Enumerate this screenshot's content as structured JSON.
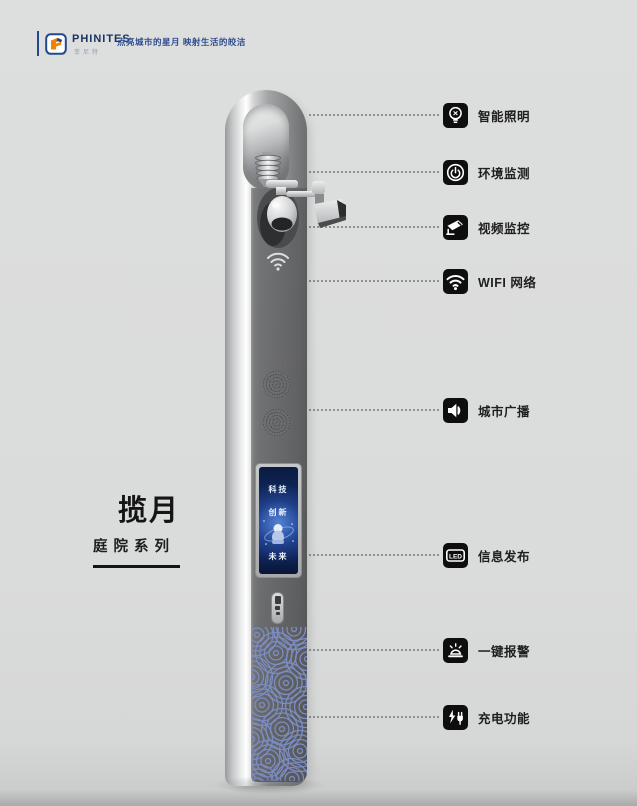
{
  "header": {
    "brand": "PHINITES",
    "brand_sub": "菲尼特",
    "tagline": "点亮城市的星月 映射生活的皎洁"
  },
  "product": {
    "title": "揽月",
    "series": "庭院系列"
  },
  "pole": {
    "screen": {
      "line1": "科技",
      "line2": "创新",
      "line3": "未来"
    }
  },
  "features": [
    {
      "id": "smart-lighting",
      "label": "智能照明",
      "icon": "bulb-icon"
    },
    {
      "id": "env-monitoring",
      "label": "环境监测",
      "icon": "env-sensor-icon"
    },
    {
      "id": "video-surveillance",
      "label": "视频监控",
      "icon": "cctv-icon"
    },
    {
      "id": "wifi-network",
      "label": "WIFI 网络",
      "icon": "wifi-icon"
    },
    {
      "id": "city-broadcast",
      "label": "城市广播",
      "icon": "speaker-icon"
    },
    {
      "id": "info-display",
      "label": "信息发布",
      "icon": "led-icon",
      "icon_text": "LED"
    },
    {
      "id": "sos-alarm",
      "label": "一键报警",
      "icon": "alarm-icon"
    },
    {
      "id": "charging",
      "label": "充电功能",
      "icon": "charging-icon"
    }
  ],
  "colors": {
    "brand_blue": "#24488c",
    "icon_bg": "#0e0e0e",
    "wave_blue": "#7b8dc3",
    "screen_blue": "#1d3f8a",
    "pole_face": "#6f7072"
  }
}
